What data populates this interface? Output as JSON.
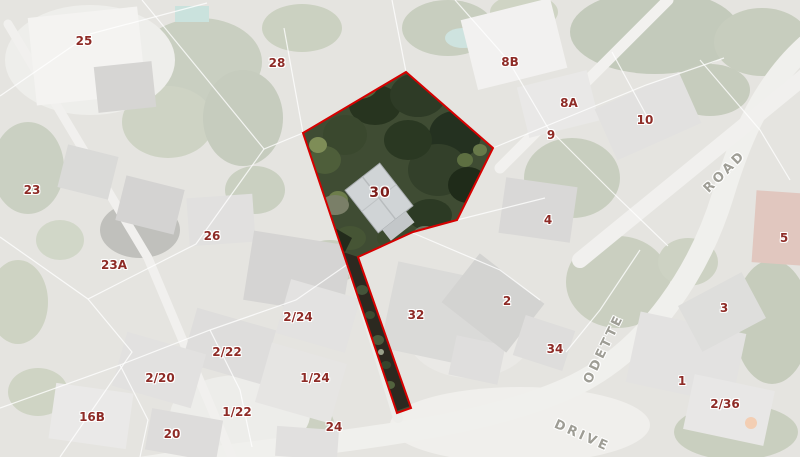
{
  "map": {
    "type": "aerial-cadastral-map",
    "highlighted_parcel": {
      "label": "30",
      "label_x": 380,
      "label_y": 193,
      "polygon_points": "406,72 493,148 457,220 413,232 358,257 411,408 397,413 303,133",
      "outline_color": "#d60000"
    },
    "parcel_labels": [
      {
        "text": "25",
        "x": 84,
        "y": 41
      },
      {
        "text": "28",
        "x": 277,
        "y": 63
      },
      {
        "text": "8B",
        "x": 510,
        "y": 62
      },
      {
        "text": "8A",
        "x": 569,
        "y": 103
      },
      {
        "text": "9",
        "x": 551,
        "y": 135
      },
      {
        "text": "10",
        "x": 645,
        "y": 120
      },
      {
        "text": "23",
        "x": 32,
        "y": 190
      },
      {
        "text": "4",
        "x": 548,
        "y": 220
      },
      {
        "text": "5",
        "x": 784,
        "y": 238
      },
      {
        "text": "26",
        "x": 212,
        "y": 236
      },
      {
        "text": "23A",
        "x": 114,
        "y": 265
      },
      {
        "text": "2",
        "x": 507,
        "y": 301
      },
      {
        "text": "3",
        "x": 724,
        "y": 308
      },
      {
        "text": "2/24",
        "x": 298,
        "y": 317
      },
      {
        "text": "32",
        "x": 416,
        "y": 315
      },
      {
        "text": "34",
        "x": 555,
        "y": 349
      },
      {
        "text": "2/22",
        "x": 227,
        "y": 352
      },
      {
        "text": "2/20",
        "x": 160,
        "y": 378
      },
      {
        "text": "1/24",
        "x": 315,
        "y": 378
      },
      {
        "text": "1",
        "x": 682,
        "y": 381
      },
      {
        "text": "2/36",
        "x": 725,
        "y": 404
      },
      {
        "text": "1/22",
        "x": 237,
        "y": 412
      },
      {
        "text": "16B",
        "x": 92,
        "y": 417
      },
      {
        "text": "20",
        "x": 172,
        "y": 434
      },
      {
        "text": "24",
        "x": 334,
        "y": 427
      }
    ],
    "street_labels": [
      {
        "text": "ROAD",
        "x": 725,
        "y": 172,
        "rotation": -45
      },
      {
        "text": "ODETTE",
        "x": 604,
        "y": 349,
        "rotation": -64
      },
      {
        "text": "DRIVE",
        "x": 582,
        "y": 436,
        "rotation": 24
      }
    ],
    "colors": {
      "parcel_label": "#8e2b26",
      "selected_label": "#7c1d1a",
      "street_label": "#9e9d95",
      "selected_outline": "#d60000"
    }
  }
}
